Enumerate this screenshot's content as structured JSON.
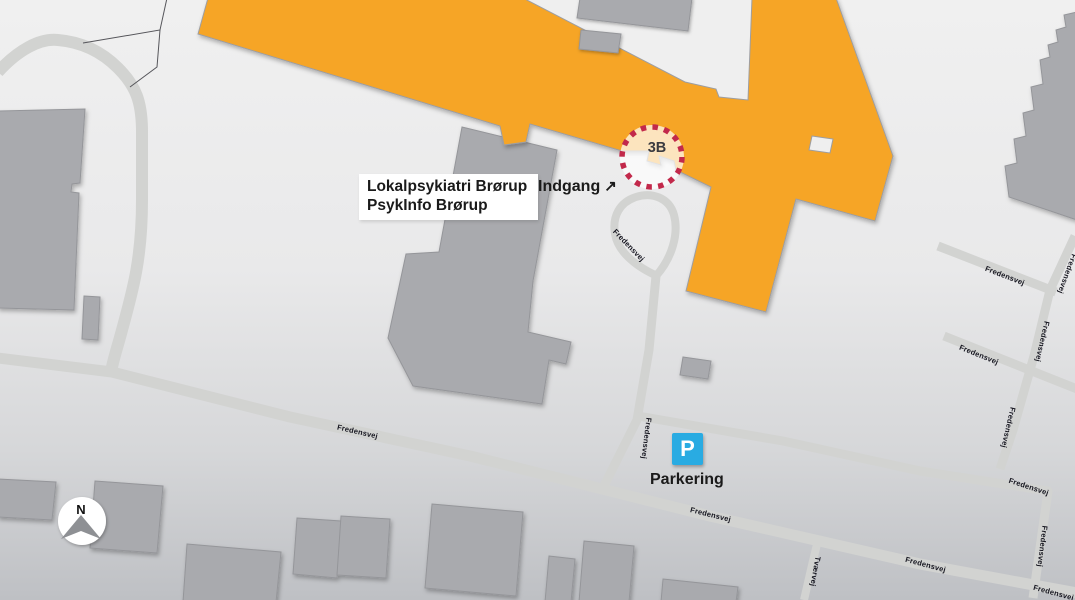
{
  "facility_box": {
    "line1": "Lokalpsykiatri Brørup",
    "line2": "PsykInfo Brørup"
  },
  "entrance": {
    "label": "Indgang",
    "arrow": "↗"
  },
  "badge_3b": "3B",
  "parking": {
    "letter": "P",
    "label": "Parkering"
  },
  "compass": {
    "north": "N"
  },
  "road_labels": [
    {
      "text": "Fredensvej",
      "x": 357,
      "y": 434,
      "rot": 13
    },
    {
      "text": "Fredensvej",
      "x": 710,
      "y": 517,
      "rot": 14
    },
    {
      "text": "Fredensvej",
      "x": 925,
      "y": 567,
      "rot": 15
    },
    {
      "text": "Fredensvej",
      "x": 1053,
      "y": 595,
      "rot": 15
    },
    {
      "text": "Fredensvej",
      "x": 627,
      "y": 247,
      "rot": 46
    },
    {
      "text": "Fredensvej",
      "x": 644,
      "y": 438,
      "rot": 97
    },
    {
      "text": "Fredensvej",
      "x": 1004,
      "y": 278,
      "rot": 21
    },
    {
      "text": "Fredensvej",
      "x": 1040,
      "y": 341,
      "rot": 103
    },
    {
      "text": "Fredensvej",
      "x": 1006,
      "y": 427,
      "rot": 103
    },
    {
      "text": "Fredensvej",
      "x": 978,
      "y": 357,
      "rot": 22
    },
    {
      "text": "Fredensvej",
      "x": 1065,
      "y": 273,
      "rot": 110
    },
    {
      "text": "Fredensvej",
      "x": 1028,
      "y": 489,
      "rot": 18
    },
    {
      "text": "Fredensvej",
      "x": 1040,
      "y": 546,
      "rot": 97
    },
    {
      "text": "Tværvej",
      "x": 813,
      "y": 571,
      "rot": 100
    }
  ],
  "colors": {
    "accent_orange": "#f6a528",
    "parking_blue": "#29abe2",
    "badge_ring_red": "#c2294b",
    "building_gray": "#a9aaae",
    "road_gray": "#d2d3d1"
  }
}
